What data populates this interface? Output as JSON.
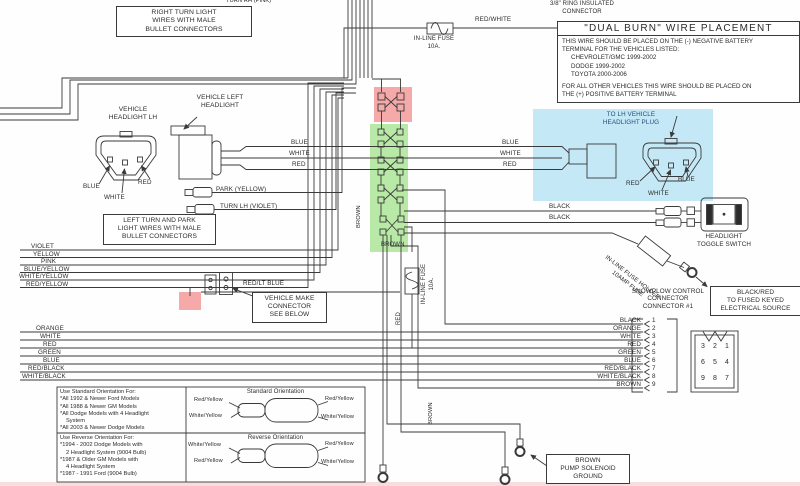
{
  "colors": {
    "line": "#3a3a3a",
    "highlight_red": "#f5a9a9",
    "highlight_green": "#b9e9a6",
    "highlight_blue": "#c5e8f6"
  },
  "top_left": {
    "right_turn_box": [
      "RIGHT TURN LIGHT",
      "WIRES WITH MALE",
      "BULLET CONNECTORS"
    ],
    "cut_text": "TURN RH (PINK)"
  },
  "top_center": {
    "fuse_label": "IN-LINE FUSE",
    "fuse_rating": "10A.",
    "wire": "RED/WHITE",
    "ring1": "3/8\" RING INSULATED",
    "ring2": "CONNECTOR"
  },
  "dual_burn": {
    "title": "\"DUAL BURN\" WIRE PLACEMENT",
    "body1": "THIS WIRE SHOULD BE PLACED ON THE (-) NEGATIVE BATTERY",
    "body2": "TERMINAL FOR THE VEHICLES LISTED:",
    "vehicles": [
      "CHEVROLET/GMC 1999-2002",
      "DODGE 1999-2002",
      "TOYOTA 2000-2006"
    ],
    "body3": "FOR ALL OTHER VEHICLES THIS WIRE SHOULD BE PLACED ON",
    "body4": "THE (+) POSITIVE BATTERY TERMINAL"
  },
  "left_headlight": {
    "title1": "VEHICLE",
    "title2": "HEADLIGHT LH",
    "pin_blue": "BLUE",
    "pin_white": "WHITE",
    "pin_red": "RED"
  },
  "vehicle_left_headlight": {
    "line1": "VEHICLE LEFT",
    "line2": "HEADLIGHT"
  },
  "park_label": "PARK (YELLOW)",
  "turn_label": "TURN LH (VIOLET)",
  "left_turn_box": [
    "LEFT TURN AND PARK",
    "LIGHT WIRES WITH MALE",
    "BULLET CONNECTORS"
  ],
  "stack1": [
    "VIOLET",
    "YELLOW",
    "PINK",
    "BLUE/YELLOW",
    "WHITE/YELLOW",
    "RED/YELLOW"
  ],
  "red_lt_blue": "RED/LT BLUE",
  "vehicle_make_box": [
    "VEHICLE MAKE",
    "CONNECTOR",
    "SEE BELOW"
  ],
  "stack2": [
    "ORANGE",
    "WHITE",
    "RED",
    "GREEN",
    "BLUE",
    "RED/BLACK",
    "WHITE/BLACK"
  ],
  "trunk_left": {
    "blue": "BLUE",
    "white": "WHITE",
    "red": "RED"
  },
  "trunk_right": {
    "blue": "BLUE",
    "white": "WHITE",
    "red": "RED"
  },
  "center": {
    "brown_side": "BROWN",
    "brown_bottom": "BROWN",
    "fuse_label": "IN-LINE FUSE",
    "fuse_rating": "10A.",
    "red_vert": "RED",
    "brown_vert2": "BROWN"
  },
  "lh_plug": {
    "title1": "TO LH VEHICLE",
    "title2": "HEADLIGHT PLUG",
    "pin_red": "RED",
    "pin_white": "WHITE",
    "pin_blue": "BLUE"
  },
  "toggle": {
    "wire1": "BLACK",
    "wire2": "BLACK",
    "label1": "HEADLIGHT",
    "label2": "TOGGLE SWITCH"
  },
  "fuse_holder": {
    "line1": "IN-LINE FUSE HOLDER",
    "line2": "10AMP FUSE"
  },
  "snowplow": {
    "heading": [
      "SNOWPLOW CONTROL",
      "CONNECTOR",
      "CONNECTOR #1"
    ],
    "rows": [
      {
        "label": "BLACK",
        "pin": "1"
      },
      {
        "label": "ORANGE",
        "pin": "2"
      },
      {
        "label": "WHITE",
        "pin": "3"
      },
      {
        "label": "RED",
        "pin": "4"
      },
      {
        "label": "GREEN",
        "pin": "5"
      },
      {
        "label": "BLUE",
        "pin": "6"
      },
      {
        "label": "RED/BLACK",
        "pin": "7"
      },
      {
        "label": "WHITE/BLACK",
        "pin": "8"
      },
      {
        "label": "BROWN",
        "pin": "9"
      }
    ],
    "pin_grid": [
      [
        "3",
        "2",
        "1"
      ],
      [
        "6",
        "5",
        "4"
      ],
      [
        "9",
        "8",
        "7"
      ]
    ]
  },
  "keyed_source_box": [
    "BLACK/RED",
    "TO FUSED KEYED",
    "ELECTRICAL SOURCE"
  ],
  "orientation": {
    "standard": {
      "header": "Use Standard Orientation For:",
      "items": [
        "*All 1992 & Newer Ford Models",
        "*All 1988 & Newer GM Models",
        "*All Dodge Models with 4 Headlight",
        "  System",
        "*All 2003 & Newer Dodge Models"
      ],
      "title": "Standard Orientation",
      "tl": "Red/Yellow",
      "bl": "White/Yellow",
      "tr": "Red/Yellow",
      "br": "White/Yellow"
    },
    "reverse": {
      "header": "Use Reverse Orientation For:",
      "items": [
        "*1994 - 2002 Dodge Models with",
        "  2 Headlight System (9004 Bulb)",
        "*1987 & Older GM Models with",
        "  4 Headlight System",
        "*1987 - 1991 Ford (9004 Bulb)"
      ],
      "title": "Reverse Orientation",
      "tl": "White/Yellow",
      "bl": "Red/Yellow",
      "tr": "Red/Yellow",
      "br": "White/Yellow"
    }
  },
  "pump_box": [
    "BROWN",
    "PUMP SOLENOID",
    "GROUND"
  ]
}
